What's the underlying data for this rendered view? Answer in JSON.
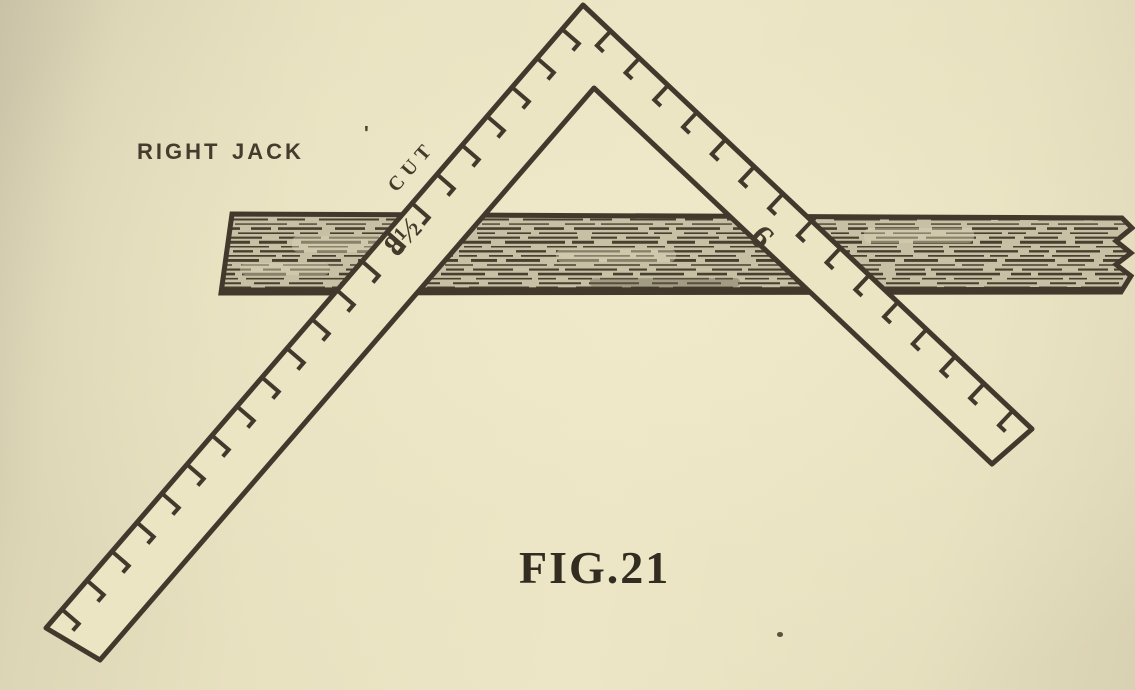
{
  "figure": {
    "title_label": "Right Jack",
    "stray_mark": "'",
    "cut_label": "Cut",
    "blade_measurement": "8½",
    "tongue_measurement": "9",
    "caption": "FIG.21"
  },
  "illustration": {
    "subject": "framing-square-over-board",
    "blade_tick_count": 21,
    "tongue_tick_count": 15
  },
  "colors": {
    "ink": "#42392c",
    "paper": "#ebe5c4",
    "board_fill": "#c7c0a5",
    "grain": "#48402f",
    "light_streak": "#d9d2b6"
  }
}
